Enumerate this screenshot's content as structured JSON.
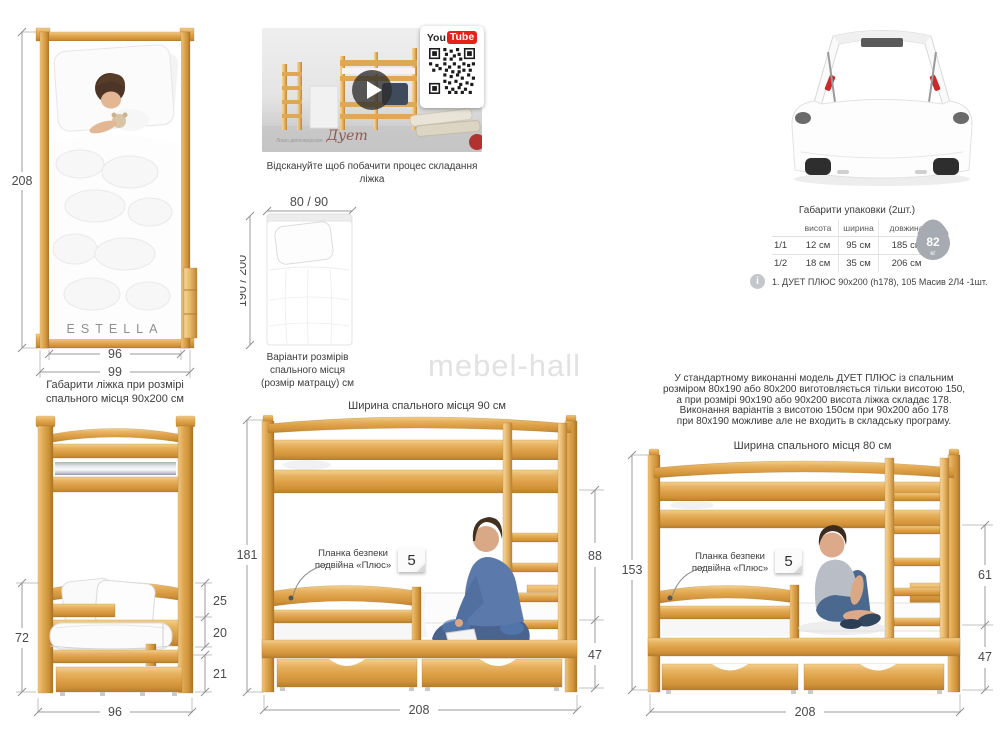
{
  "watermark": "mebel-hall",
  "top_view": {
    "brand": "ESTELLA",
    "dims": {
      "height": "208",
      "width_inner": "96",
      "width_outer": "99"
    }
  },
  "video": {
    "caption": "Відскануйте щоб побачити процес складання ліжка",
    "overlay_label_line1": "Ліжко",
    "overlay_label_line2": "двоповерхове",
    "overlay_script": "Дует",
    "youtube": {
      "you": "You",
      "tube": "Tube"
    }
  },
  "mattress_options": {
    "width_label": "80 / 90",
    "length_label": "190 / 200",
    "caption": [
      "Варіанти розмірів",
      "спального місця",
      "(розмір матрацу) см"
    ]
  },
  "packaging": {
    "title": "Габарити упаковки (2шт.)",
    "columns": [
      "висота",
      "ширина",
      "довжина"
    ],
    "rows": [
      {
        "label": "1/1",
        "values": [
          "12 см",
          "95 см",
          "185 см"
        ]
      },
      {
        "label": "1/2",
        "values": [
          "18 см",
          "35 см",
          "206 см"
        ]
      }
    ],
    "weight": {
      "value": "82",
      "unit": "кг"
    },
    "note": "1. ДУЕТ ПЛЮС 90х200 (h178), 105 Масив 2Л4 -1шт."
  },
  "front_view": {
    "title": [
      "Габарити ліжка при розмірі",
      "спального місця 90х200 см"
    ],
    "dims": {
      "lower_height": "72",
      "rail": "25",
      "mattress": "20",
      "drawer": "21",
      "width": "96"
    }
  },
  "side_view_90": {
    "title": "Ширина спального місця 90 см",
    "dims": {
      "total_height": "181",
      "upper_gap": "88",
      "lower": "47",
      "length": "208"
    },
    "plank_label": [
      "Планка безпеки",
      "подвійна «Плюс»"
    ],
    "plank_note": "5"
  },
  "side_view_80": {
    "title": "Ширина спального місця 80 см",
    "paragraph": [
      "У стандартному виконанні модель ДУЕТ ПЛЮС із спальним",
      "розміром 80х190 або 80х200 виготовляється тільки висотою 150,",
      "а при розмірі 90х190 або 90х200 висота ліжка складає 178.",
      "Виконання варіантів з висотою 150см при 90х200 або 178",
      "при 80х190 можливе але не входить в складську програму."
    ],
    "dims": {
      "total_height": "153",
      "upper_gap": "61",
      "lower": "47",
      "length": "208"
    },
    "plank_label": [
      "Планка безпеки",
      "подвійна «Плюс»"
    ],
    "plank_note": "5"
  }
}
